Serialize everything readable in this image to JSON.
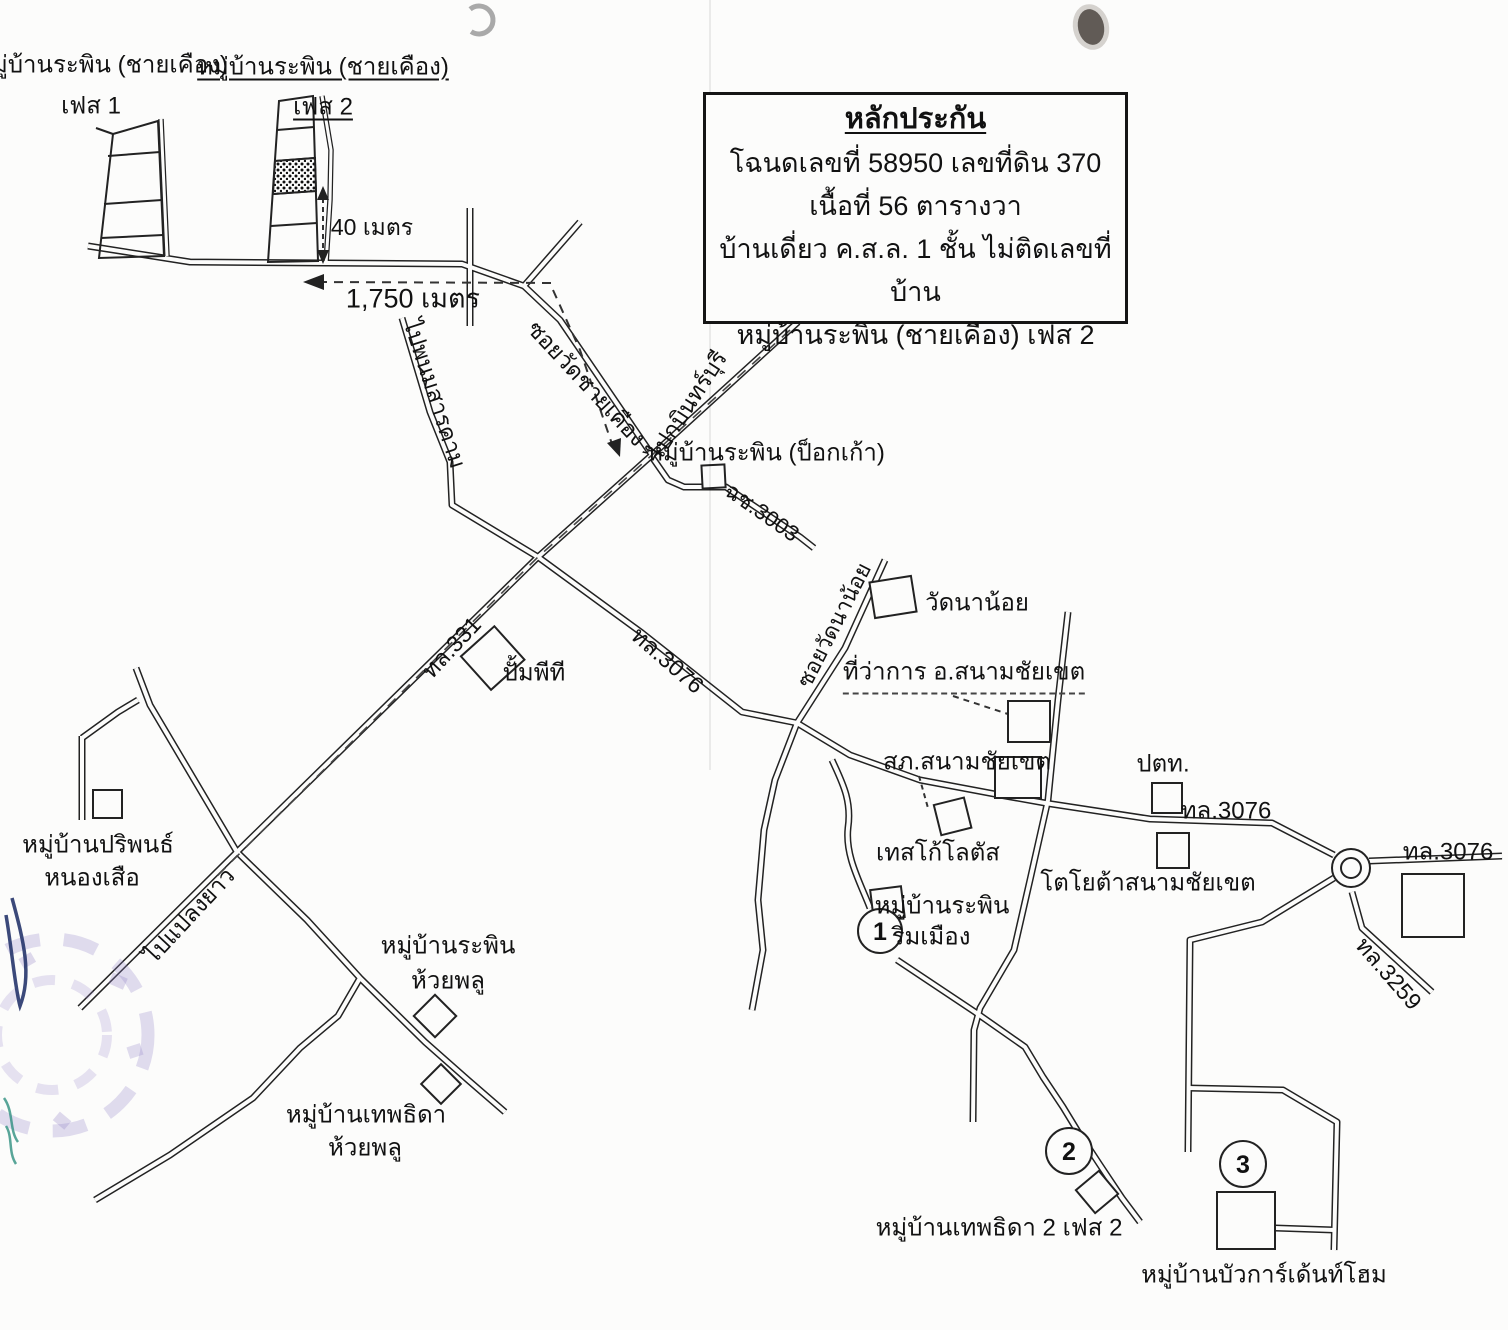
{
  "collateral_box": {
    "title": "หลักประกัน",
    "deed_line": "โฉนดเลขที่ 58950  เลขที่ดิน 370",
    "area_line": "เนื้อที่ 56  ตารางวา",
    "building_line": "บ้านเดี่ยว ค.ส.ล. 1 ชั้น ไม่ติดเลขที่บ้าน",
    "village_line": "หมู่บ้านระพิน (ชายเคือง) เฟส 2"
  },
  "villages": {
    "rapin_chaikhueang": "หมู่บ้านระพิน (ชายเคือง)",
    "phase1": "เฟส 1",
    "phase2": "เฟส 2",
    "rapin_pokkao": "หมู่บ้านระพิน (ป็อกเก้า)",
    "pariphon": "หมู่บ้านปริพนธ์",
    "nongsuea": "หนองเสือ",
    "rapin": "หมู่บ้านระพิน",
    "huaiphlu": "ห้วยพลู",
    "thepthida": "หมู่บ้านเทพธิดา",
    "rimmueang": "ริมเมือง",
    "thepthida2": "หมู่บ้านเทพธิดา 2 เฟส 2",
    "bua_garden_home": "หมู่บ้านบัวการ์เด้นท์โฮม"
  },
  "places": {
    "wat_nanoi": "วัดนาน้อย",
    "district_office": "ที่ว่าการ อ.สนามชัยเขต",
    "police_station": "สภ.สนามชัยเขต",
    "tesco_lotus": "เทสโก้โลตัส",
    "ptt": "ปตท.",
    "pt_gas_station": "ปั้มพีที",
    "toyota": "โตโยต้าสนามชัยเขต"
  },
  "roads": {
    "hwy331": "ทล.331",
    "hwy3076": "ทล.3076",
    "hwy3259": "ทล.3259",
    "rural3003": "ฉช.3003",
    "soi_wat_chaikhueang": "ซอยวัดชายเคือง",
    "soi_wat_nanoi": "ซอยวัดนาน้อย",
    "to_phanom_sarakham": "ไปพนมสารคาม",
    "to_kabin_buri": "ไปกบินทร์บุรี",
    "to_plaeng_yao": "ไปแปลงยาว"
  },
  "measurements": {
    "depth_40m": "40 เมตร",
    "distance_1750m": "1,750 เมตร"
  },
  "markers": {
    "m1": "1",
    "m2": "2",
    "m3": "3"
  }
}
